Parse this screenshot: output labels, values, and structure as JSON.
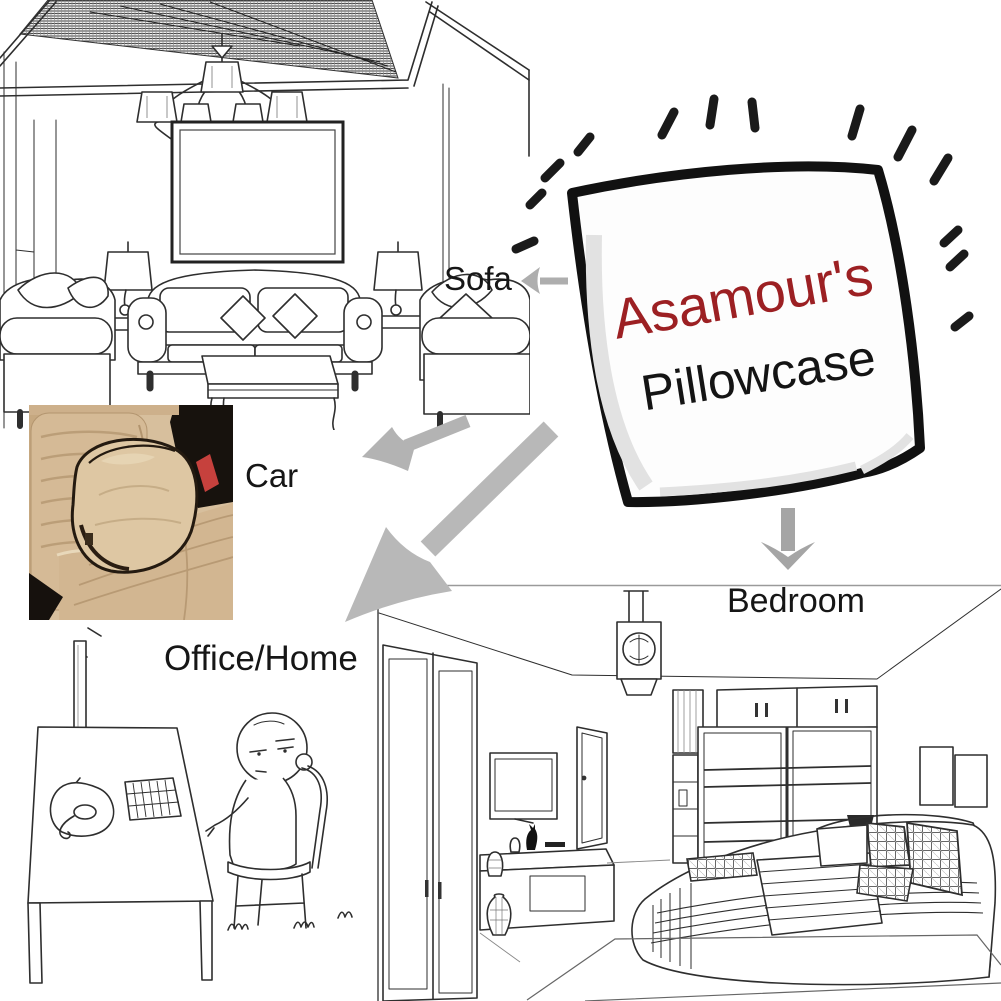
{
  "pillow": {
    "brand": "Asamour's",
    "product": "Pillowcase",
    "brand_color": "#9c2023",
    "product_color": "#141414"
  },
  "labels": {
    "sofa": "Sofa",
    "car": "Car",
    "office": "Office/Home",
    "bedroom": "Bedroom"
  },
  "colors": {
    "arrow_gray": "#aeaeae",
    "sketch_line": "#2e2e2e",
    "label_text": "#161616",
    "car_photo_seat_beige": "#d5ba96",
    "car_photo_pillow_beige": "#dec7a3",
    "car_photo_piping_brown": "#241a10",
    "car_photo_shadow_dark": "#17120d",
    "car_photo_buckle_red": "#c6413d"
  }
}
